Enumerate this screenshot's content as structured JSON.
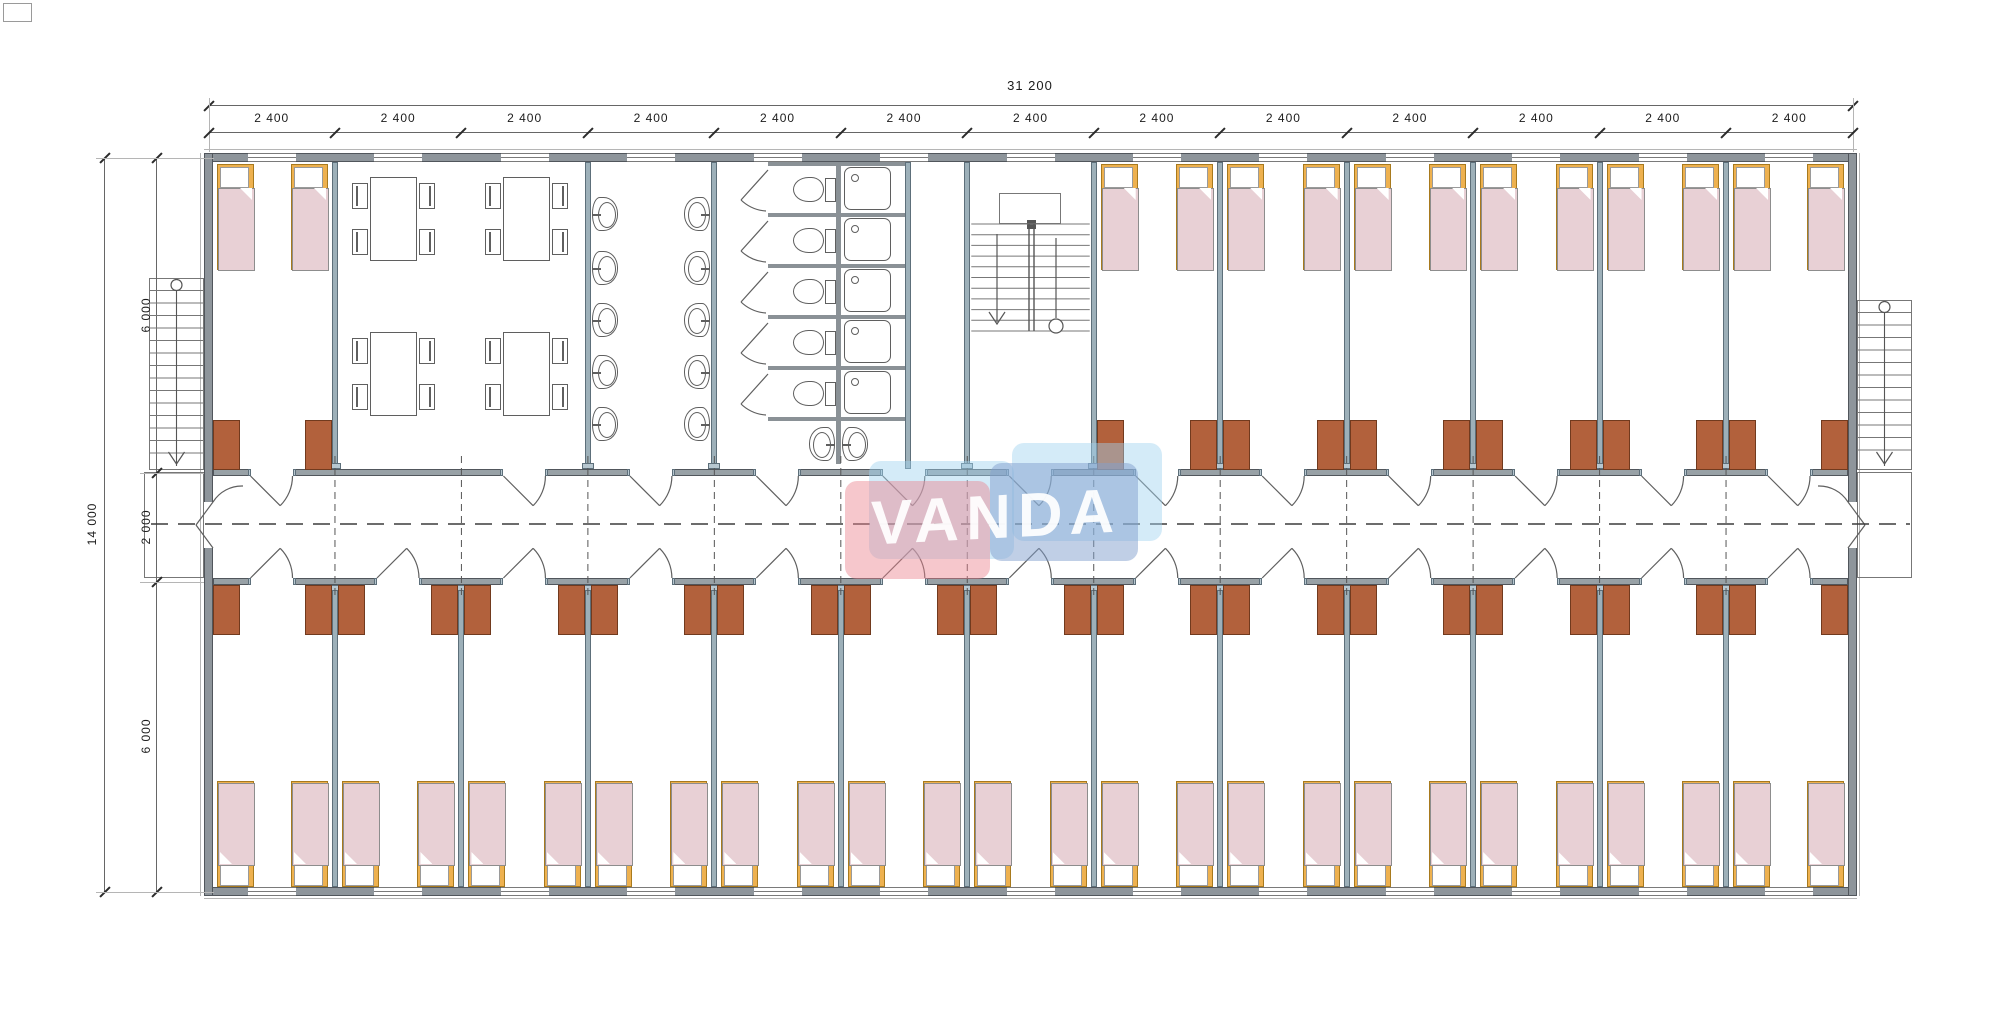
{
  "title": "dormitory-floor-plan",
  "logo": {
    "text": "VANDA",
    "red_color": "rgba(236,131,142,0.45)",
    "blue_color": "rgba(130,160,205,0.50)",
    "pale_color": "rgba(160,210,240,0.45)",
    "text_color": "rgba(255,255,255,0.93)"
  },
  "dimensions": {
    "top_total_label": "31 200",
    "module_label": "2 400",
    "module_count": 13,
    "left_total_label": "14 000",
    "left_segment_labels": [
      "6 000",
      "2 000",
      "6 000"
    ]
  },
  "plan": {
    "module_count": 13,
    "top_zone_types": [
      "bedroom",
      "dining",
      "dining",
      "washroom",
      "wc",
      "wc",
      "stair",
      "bedroom",
      "bedroom",
      "bedroom",
      "bedroom",
      "bedroom",
      "bedroom"
    ],
    "top_door_modules": [
      0,
      2,
      3,
      4,
      5,
      6,
      7,
      8,
      9,
      10,
      11,
      12
    ],
    "bottom_rooms": 13,
    "beds_per_room": 2,
    "desks_per_room": 2,
    "dining": {
      "tables": 4,
      "chairs_per_table": 4
    },
    "washroom": {
      "basins": 10
    },
    "sanitary": {
      "wc_stalls": 5,
      "showers": 5,
      "basins": 2
    },
    "stairs": {
      "internal": 1,
      "external": 2
    }
  },
  "colors": {
    "outer_wall": "#8e959b",
    "outer_wall_edge": "#51565c",
    "partition": "#9db0b9",
    "partition_edge": "#5d6f7a",
    "partition_cap": "#b7c7d0",
    "corridor_wall": "#98a1a6",
    "stall_wall": "#8a9196",
    "bed_frame": "#eeb14f",
    "bed_frame_edge": "#a87a1e",
    "mattress": "#e8d0d5",
    "mattress_edge": "#8d8d8d",
    "pillow": "#ffffff",
    "desk": "#b2613c",
    "desk_edge": "#713a1e",
    "fixture_line": "#5f5f5f",
    "dim_line": "#666666",
    "dim_tick": "#2b2b2b",
    "dim_text": "#1c1c1c",
    "dash_line": "#3c3c3c",
    "window_line": "#7a7a7a",
    "hairline": "#b5b5b5"
  }
}
